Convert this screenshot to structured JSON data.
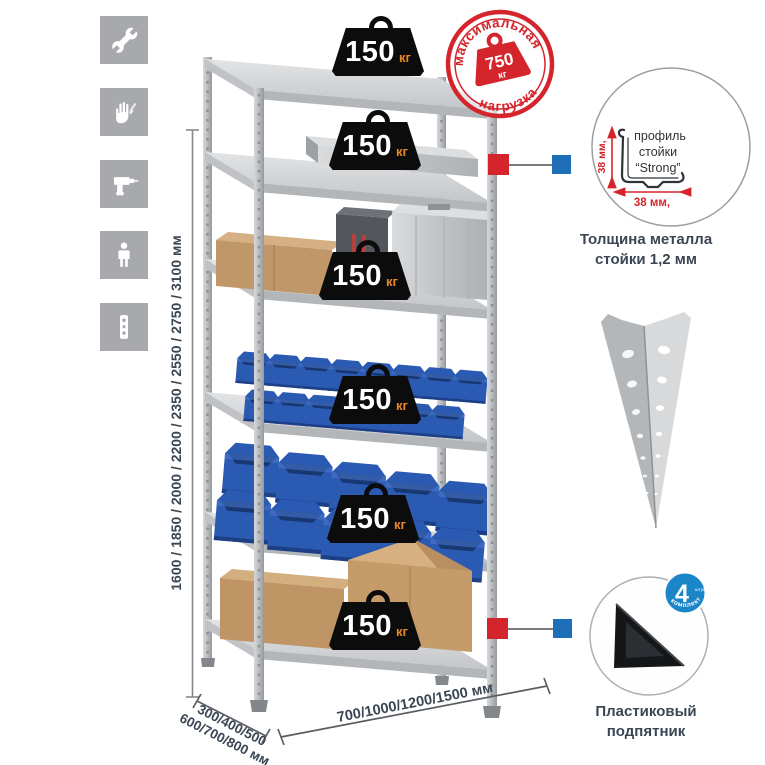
{
  "colors": {
    "red": "#d5252c",
    "blue_connector": "#1e6fb8",
    "navy_text": "#3b4654",
    "icon_bg": "#a7a9ac",
    "badge_orange": "#e8872a",
    "included_badge_blue": "#1a86c8"
  },
  "icons": [
    {
      "name": "wrench"
    },
    {
      "name": "gloves"
    },
    {
      "name": "drill"
    },
    {
      "name": "person"
    },
    {
      "name": "upright-profile"
    }
  ],
  "height_dimension": {
    "label": "1600 / 1850 / 2000 / 2200 / 2350 / 2550 / 2750 / 3100 мм"
  },
  "shelf_load_badge": {
    "value": "150",
    "unit": "кг"
  },
  "max_load_stamp": {
    "arc_top": "максимальная",
    "arc_bottom": "нагрузка",
    "value": "750",
    "unit": "кг"
  },
  "profile_detail": {
    "line1": "профиль",
    "line2": "стойки",
    "line3": "“Strong”",
    "dim_vertical": "38 мм,",
    "dim_horizontal": "38 мм,",
    "caption_line1": "Толщина металла",
    "caption_line2": "стойки 1,2 мм"
  },
  "included_badge": {
    "count": "4",
    "count_note": "штуки",
    "arc": "в комплекте"
  },
  "foot": {
    "caption_line1": "Пластиковый",
    "caption_line2": "подпятник"
  },
  "depth_dimension": {
    "line1": "300/400/500",
    "line2": "600/700/800 мм"
  },
  "width_dimension": {
    "label": "700/1000/1200/1500 мм"
  }
}
